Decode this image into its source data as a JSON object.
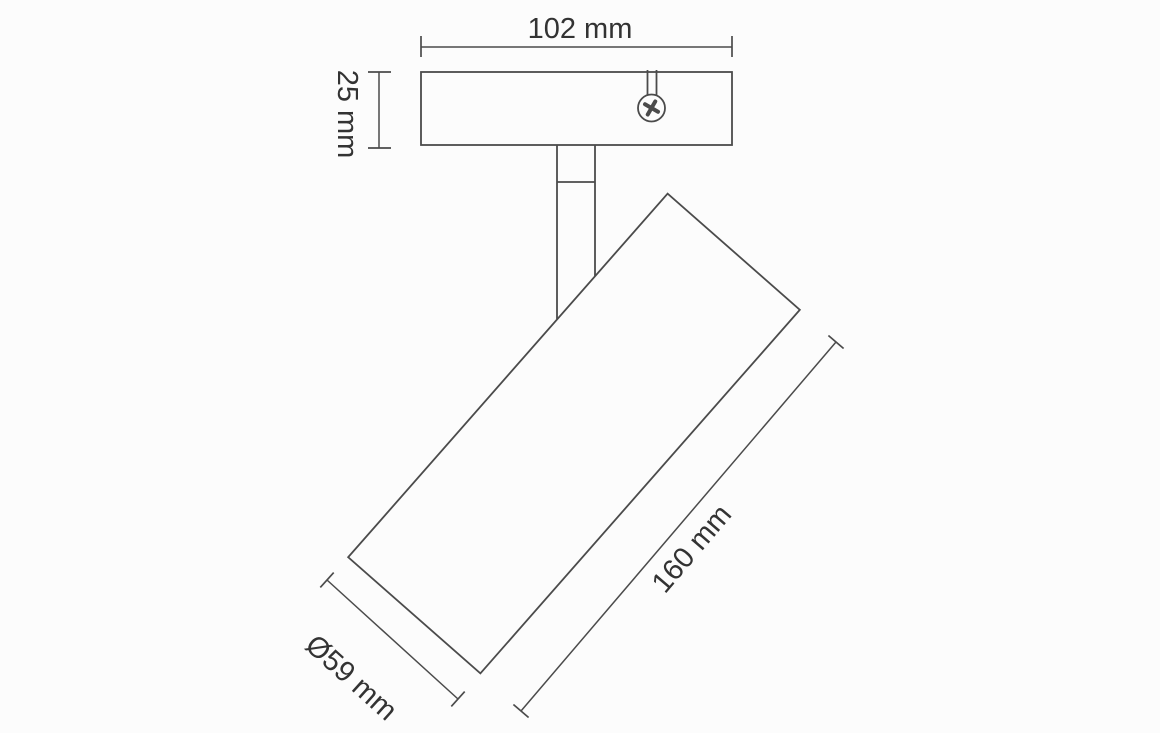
{
  "colors": {
    "background": "#fcfcfc",
    "line": "#4b4b4b",
    "text": "#333333"
  },
  "drawing": {
    "type": "technical-dimension-diagram",
    "subject": "ceiling spotlight with mounting plate, pivot stem and tilted cylindrical head",
    "icons": {
      "screw_head": "phillips-screw-icon"
    },
    "dimensions": {
      "width": {
        "label": "102 mm",
        "value": 102,
        "unit": "mm"
      },
      "height": {
        "label": "25 mm",
        "value": 25,
        "unit": "mm"
      },
      "length": {
        "label": "160 mm",
        "value": 160,
        "unit": "mm"
      },
      "diameter": {
        "label": "Ø59 mm",
        "value": 59,
        "unit": "mm"
      }
    }
  }
}
